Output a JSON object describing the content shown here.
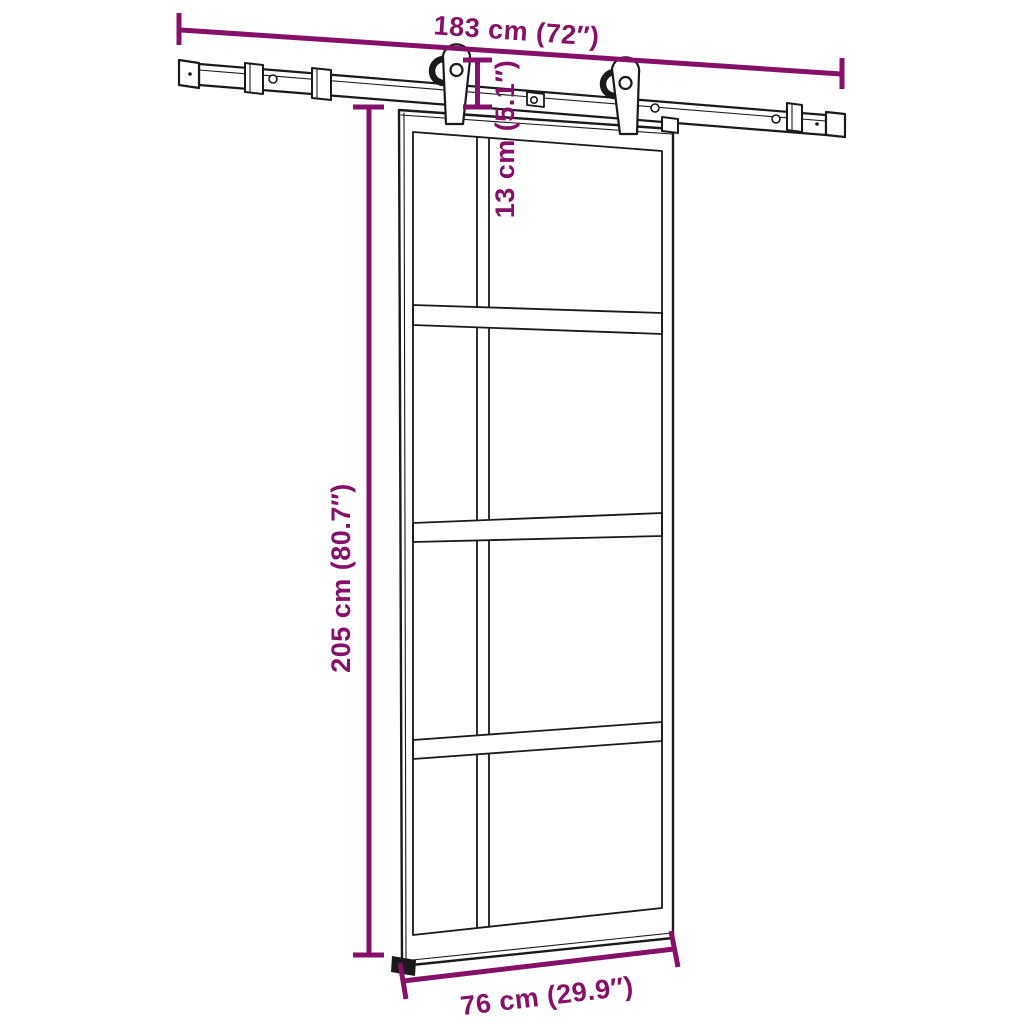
{
  "diagram": {
    "title": "sliding-door-with-hardware-kit-dimension-diagram",
    "colors": {
      "dimension_accent": "#861069",
      "line_art": "#1a1a1a",
      "background": "#ffffff"
    },
    "labels": {
      "rail_length": "183 cm (72″)",
      "drop_height": "13 cm (5.1″)",
      "door_height": "205 cm (80.7″)",
      "door_width": "76 cm (29.9″)"
    },
    "parts": [
      "sliding-rail",
      "rail-end-caps",
      "wall-spacer-brackets",
      "roller-hanger-left",
      "roller-hanger-right",
      "door-stop-clip",
      "glass-door-4-panel",
      "floor-guide"
    ]
  }
}
